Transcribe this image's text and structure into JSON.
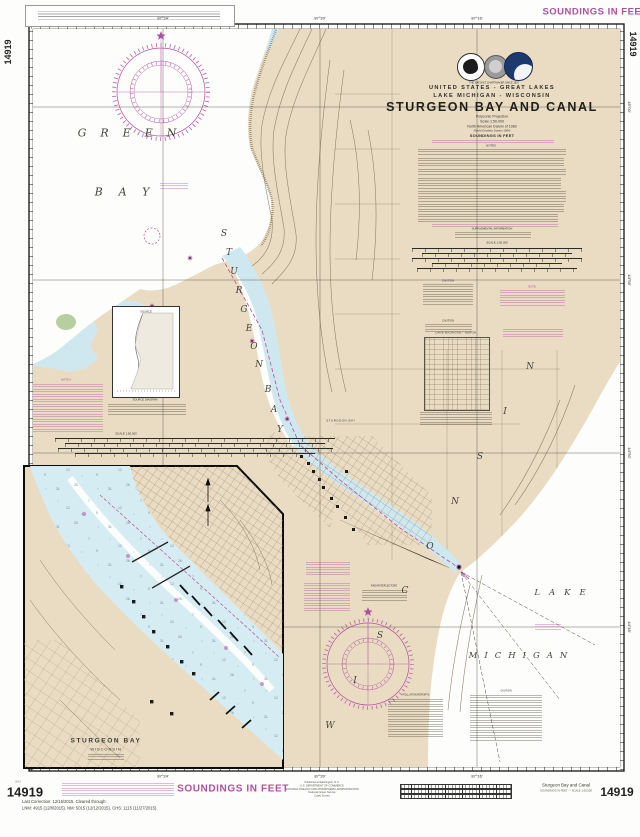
{
  "chart": {
    "number": "14919",
    "print_year": "2015"
  },
  "margins": {
    "soundings_top": "SOUNDINGS IN FEET",
    "soundings_bottom": "SOUNDINGS IN FEET",
    "last_correction": "Last Correction: 12/16/2015.  Cleared through:",
    "cleared_refs": "LNM: 4915 (12/8/2015), NM: 5015 (12/12/2015), CHS: 1115 (11/27/2015)",
    "imprint": [
      "Published at Washington, D.C.",
      "U.S. DEPARTMENT OF COMMERCE",
      "NATIONAL OCEANIC AND ATMOSPHERIC ADMINISTRATION",
      "National Ocean Service",
      "Coast Survey"
    ],
    "footer_title": "Sturgeon Bay and Canal",
    "footer_subtitle": "SOUNDINGS IN FEET — SCALE 1:50,000"
  },
  "titleblock": {
    "banner": "THE NATION'S CHARTMAKER SINCE 1807",
    "region": "UNITED STATES - GREAT LAKES",
    "subregion": "LAKE MICHIGAN - WISCONSIN",
    "title": "STURGEON BAY AND CANAL",
    "projection": "Polyconic Projection",
    "scale": "Scale 1:50,000",
    "datum": "North American Datum of 1983",
    "datum2": "(World Geodetic System 1984)",
    "soundings": "SOUNDINGS IN FEET"
  },
  "notes": {
    "notes_header": "NOTES",
    "supplemental": "SUPPLEMENTAL INFORMATION",
    "scale_label": "SCALE 1:50,000",
    "scale_label_left": "SCALE 1:50,000",
    "caution1": "CAUTION",
    "caution2": "CAUTION",
    "note_right": "NOTE",
    "note_a": "NOTE A",
    "radar": "RADAR REFLECTORS",
    "pollution": "POLLUTION REPORTS",
    "caution3": "CAUTION",
    "water_table_header": "LAKE MICHIGAN - HURON",
    "source_header": "SOURCE",
    "source_caption": "SOURCE DIAGRAM"
  },
  "places": {
    "green": "GREEN",
    "bay": "BAY",
    "lake": "LAKE",
    "michigan": "MICHIGAN",
    "city": "STURGEON BAY",
    "inset_title": "STURGEON BAY",
    "inset_state": "WISCONSIN"
  },
  "scatter": {
    "sturgeon": [
      {
        "t": "S",
        "x": 224,
        "y": 234
      },
      {
        "t": "T",
        "x": 229,
        "y": 253
      },
      {
        "t": "U",
        "x": 234,
        "y": 272
      },
      {
        "t": "R",
        "x": 239,
        "y": 291
      },
      {
        "t": "G",
        "x": 244,
        "y": 310
      },
      {
        "t": "E",
        "x": 249,
        "y": 329
      },
      {
        "t": "O",
        "x": 254,
        "y": 347
      },
      {
        "t": "N",
        "x": 259,
        "y": 365
      }
    ],
    "bay_word": [
      {
        "t": "B",
        "x": 268,
        "y": 390
      },
      {
        "t": "A",
        "x": 274,
        "y": 410
      },
      {
        "t": "Y",
        "x": 280,
        "y": 430
      }
    ],
    "wisconsin": [
      {
        "t": "W",
        "x": 330,
        "y": 726
      },
      {
        "t": "I",
        "x": 355,
        "y": 681
      },
      {
        "t": "S",
        "x": 380,
        "y": 636
      },
      {
        "t": "C",
        "x": 405,
        "y": 591
      },
      {
        "t": "O",
        "x": 430,
        "y": 547
      },
      {
        "t": "N",
        "x": 455,
        "y": 502
      },
      {
        "t": "S",
        "x": 480,
        "y": 457
      },
      {
        "t": "I",
        "x": 505,
        "y": 412
      },
      {
        "t": "N",
        "x": 530,
        "y": 367
      }
    ],
    "lon_top": [
      {
        "t": "87°24'",
        "x": 163,
        "y": 18
      },
      {
        "t": "87°20'",
        "x": 320,
        "y": 18
      },
      {
        "t": "87°16'",
        "x": 477,
        "y": 18
      }
    ],
    "lon_bottom": [
      {
        "t": "87°24'",
        "x": 163,
        "y": 776
      },
      {
        "t": "87°20'",
        "x": 320,
        "y": 776
      },
      {
        "t": "87°16'",
        "x": 477,
        "y": 776
      }
    ],
    "lat_right": [
      {
        "t": "45°00'",
        "x": 629,
        "y": 107
      },
      {
        "t": "44°55'",
        "x": 629,
        "y": 280
      },
      {
        "t": "44°50'",
        "x": 629,
        "y": 453
      },
      {
        "t": "44°45'",
        "x": 629,
        "y": 627
      }
    ]
  },
  "colors": {
    "magenta": "#b0509e",
    "land": "#e9dcc3",
    "shallow_water": "#cfe8f0",
    "deep_water": "#fdfdfb",
    "contour": "#8a7a5f"
  }
}
